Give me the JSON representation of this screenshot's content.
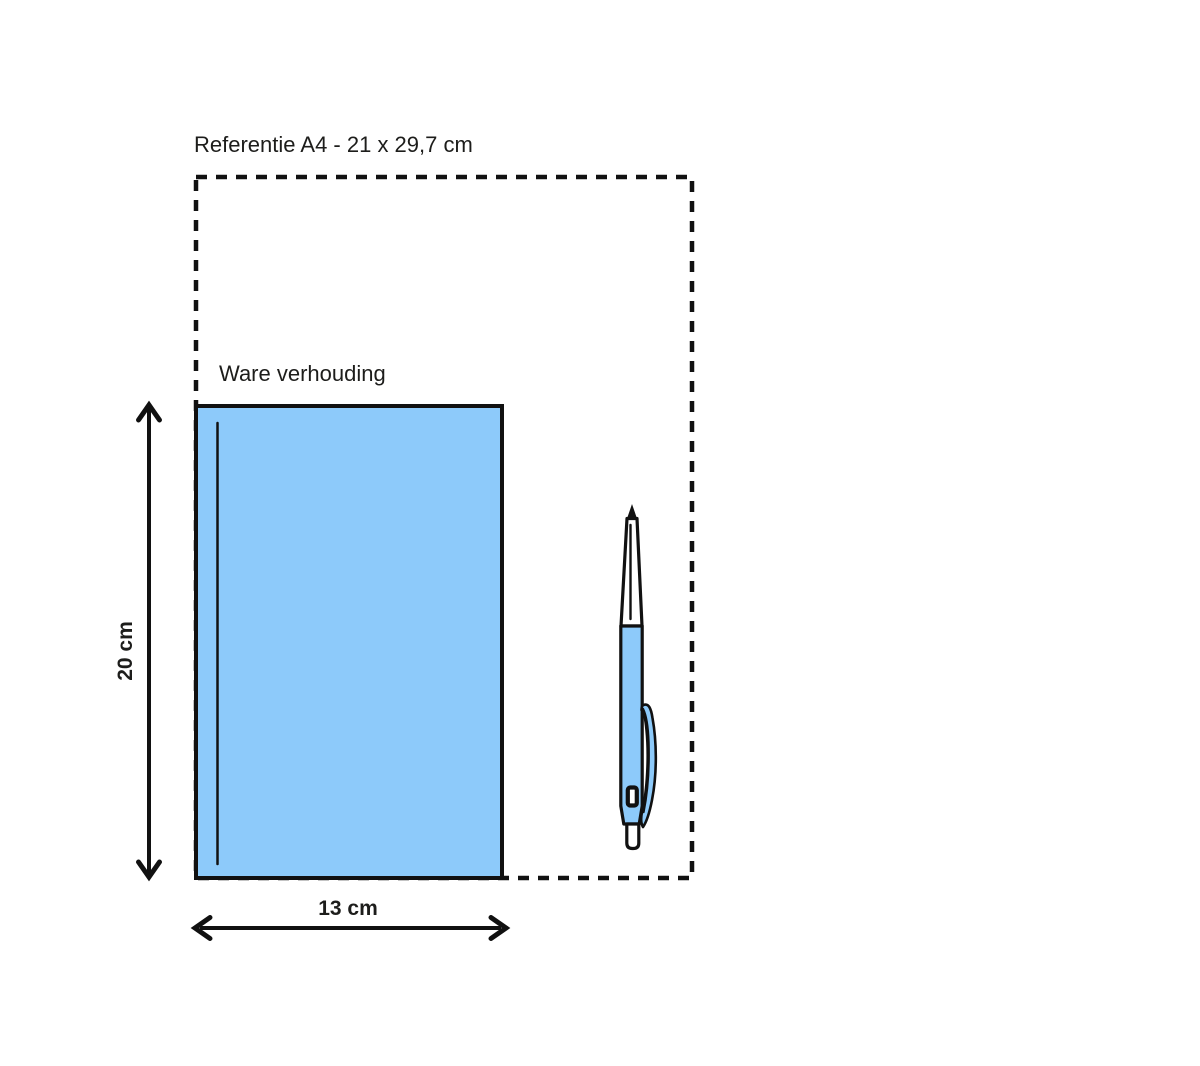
{
  "diagram": {
    "reference_label": "Referentie A4 - 21 x 29,7 cm",
    "scale_label": "Ware verhouding",
    "height_label": "20 cm",
    "width_label": "13 cm",
    "dimensions": {
      "reference_format": "A4",
      "reference_size_cm": "21 x 29,7",
      "product_height_cm": "20",
      "product_width_cm": "13"
    },
    "colors": {
      "outline": "#111111",
      "product_fill": "#8dcafa",
      "text": "#1d1d1b",
      "background": "#ffffff"
    }
  }
}
